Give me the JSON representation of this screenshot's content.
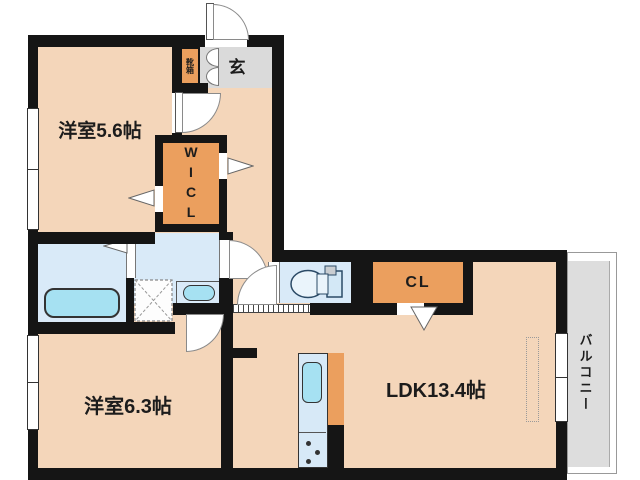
{
  "floorplan": {
    "room1_label": "洋室5.6帖",
    "room2_label": "洋室6.3帖",
    "ldk_label": "LDK13.4帖",
    "entrance_label": "玄",
    "shoe_cabinet_label": "靴箱",
    "walk_in_closet_label": "WICL",
    "closet_label": "CL",
    "balcony_label": "バルコニー"
  },
  "icons": {
    "bathtub-icon": "rounded rectangle tub",
    "washing-machine-pan-icon": "dashed square with X",
    "washbasin-icon": "oval basin in counter",
    "toilet-icon": "toilet bowl with tank",
    "kitchen-sink-icon": "sink with stove burner dots",
    "door-arc-icon": "quarter-circle door swing",
    "opening-arrow-icon": "white triangle opening marker"
  },
  "colors": {
    "room_fill": "#F4D6BA",
    "closet_fill": "#EB9F5E",
    "wet_area_fill": "#D9EAF8",
    "fixture_fill": "#A6E1F2",
    "entrance_fill": "#DADADA",
    "balcony_fill": "#DDDDDD",
    "wall": "#151515"
  }
}
